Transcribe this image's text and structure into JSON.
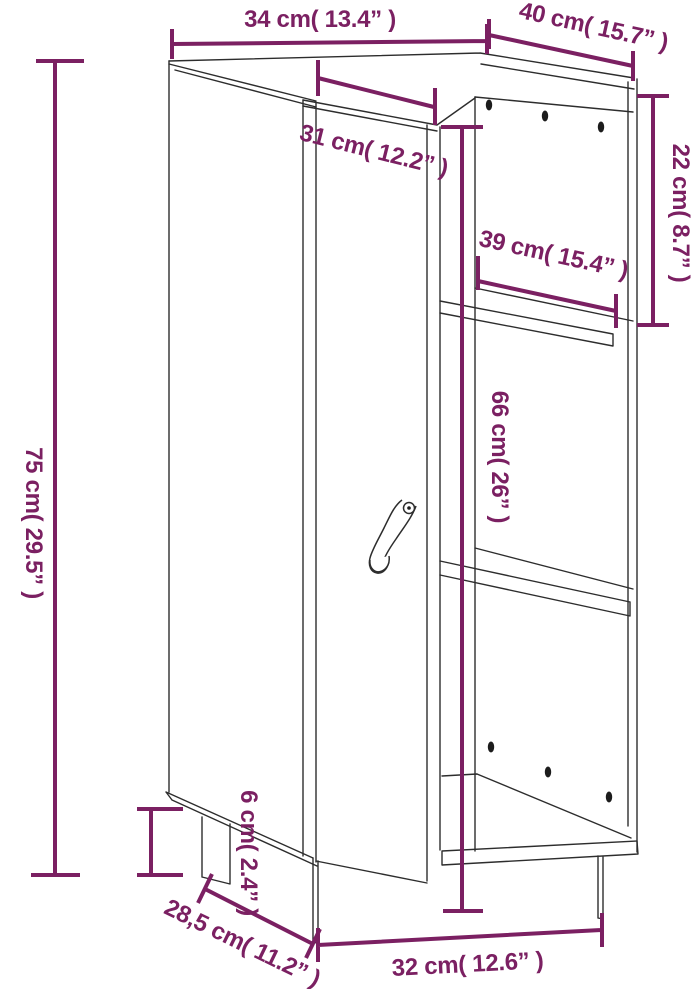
{
  "diagram": {
    "kind": "furniture-dimension-line-drawing",
    "item": "sideboard with door and open side shelves",
    "colors": {
      "dimension_accent": "#7b2062",
      "outline": "#2d2d2d",
      "background": "#ffffff"
    },
    "dimensions": [
      {
        "id": "top-width",
        "label": "34 cm( 13.4” )",
        "cm": "34",
        "inch": "13.4"
      },
      {
        "id": "top-depth",
        "label": "40 cm( 15.7” )",
        "cm": "40",
        "inch": "15.7"
      },
      {
        "id": "door-width",
        "label": "31 cm( 12.2” )",
        "cm": "31",
        "inch": "12.2"
      },
      {
        "id": "top-compartment-height",
        "label": "22 cm( 8.7” )",
        "cm": "22",
        "inch": "8.7"
      },
      {
        "id": "shelf-depth",
        "label": "39 cm( 15.4” )",
        "cm": "39",
        "inch": "15.4"
      },
      {
        "id": "side-opening-height",
        "label": "66 cm( 26” )",
        "cm": "66",
        "inch": "26"
      },
      {
        "id": "overall-height",
        "label": "75 cm( 29.5” )",
        "cm": "75",
        "inch": "29.5"
      },
      {
        "id": "leg-height",
        "label": "6 cm( 2.4” )",
        "cm": "6",
        "inch": "2.4"
      },
      {
        "id": "base-depth",
        "label": "28,5 cm( 11.2” )",
        "cm": "28,5",
        "inch": "11.2"
      },
      {
        "id": "base-width",
        "label": "32 cm( 12.6” )",
        "cm": "32",
        "inch": "12.6"
      }
    ]
  }
}
